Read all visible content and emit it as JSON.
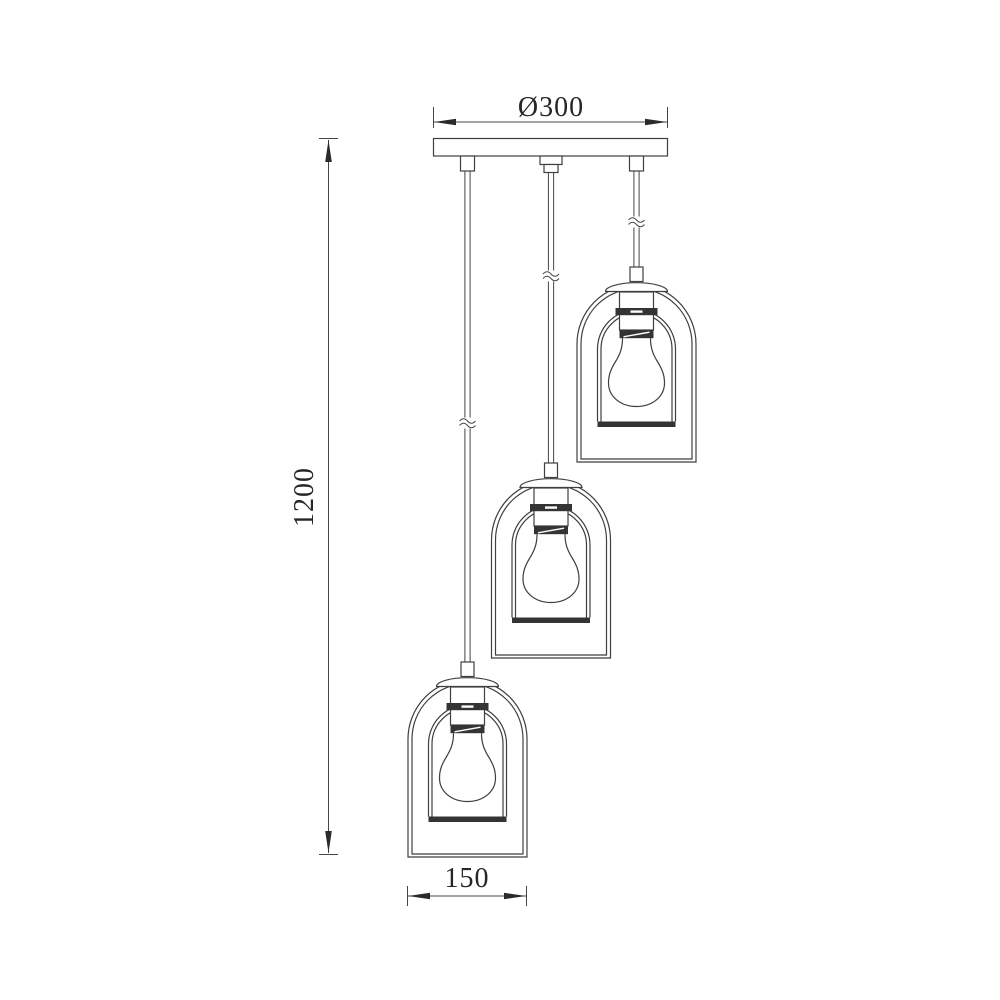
{
  "drawing": {
    "kind": "technical-dimension-diagram",
    "subject": "three-light staggered pendant lamp with double glass shades",
    "background_color": "#ffffff",
    "line_color": "#3f3f3f",
    "text_color": "#262626",
    "lamp_count": 3,
    "dimensions": {
      "canopy_diameter": {
        "label": "Ø300",
        "value": 300
      },
      "overall_height": {
        "label": "1200",
        "value": 1200
      },
      "shade_width": {
        "label": "150",
        "value": 150
      }
    }
  }
}
